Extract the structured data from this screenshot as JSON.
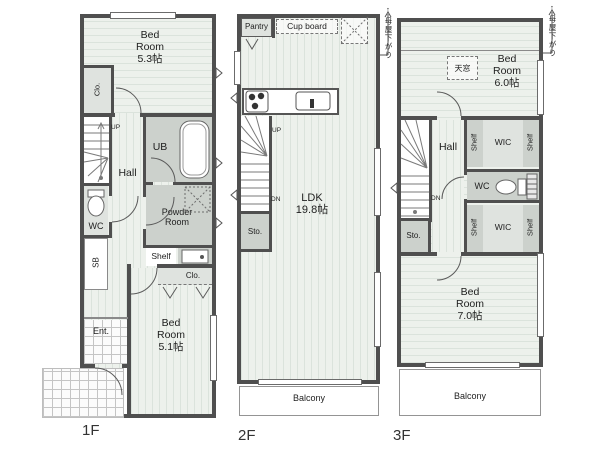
{
  "title": "3-story house floor plan",
  "colors": {
    "wall": "#4f4f4f",
    "floor": "#edf1ec",
    "wet_area": "#ccd1cc",
    "background": "#ffffff"
  },
  "icons": {
    "bathtub": "rounded-rect",
    "toilet": "ellipse-with-tank",
    "stove": "three-burner-dots",
    "sink": "rect-basin",
    "hanger": "v-shape",
    "washer_space": "dashed-x-box",
    "refrigerator_space": "dashed-x-box",
    "skylight": "dashed-rect",
    "door": "quarter-arc",
    "window": "double-line",
    "stairs": "step-lines"
  },
  "floor1": {
    "label": "1F",
    "bedroom_top": "Bed\nRoom\n5.3帖",
    "closet_top": "Clo.",
    "up": "UP",
    "hall": "Hall",
    "bath": "UB",
    "toilet": "WC",
    "powder_room": "Powder\nRoom",
    "shelf": "Shelf",
    "closet_mid": "Clo.",
    "shoe_box": "SB",
    "entrance": "Ent.",
    "bedroom_bottom": "Bed\nRoom\n5.1帖"
  },
  "floor2": {
    "label": "2F",
    "pantry": "Pantry",
    "cupboard": "Cup board",
    "up": "UP",
    "down": "DN",
    "living": "LDK\n19.8帖",
    "storage": "Sto.",
    "balcony": "Balcony",
    "roof_note": "母屋下がり",
    "roof_arrow": "↑"
  },
  "floor3": {
    "label": "3F",
    "bedroom_top": "Bed\nRoom\n6.0帖",
    "skylight": "天窓",
    "roof_note": "母屋下がり",
    "roof_arrow": "↑",
    "hall": "Hall",
    "down": "DN",
    "wic_top": "WIC",
    "wic_bottom": "WIC",
    "shelf_top_left": "Shelf",
    "shelf_top_right": "Shelf",
    "shelf_bottom_left": "Shelf",
    "shelf_bottom_right": "Shelf",
    "toilet": "WC",
    "storage": "Sto.",
    "bedroom_bottom": "Bed\nRoom\n7.0帖",
    "balcony": "Balcony"
  }
}
